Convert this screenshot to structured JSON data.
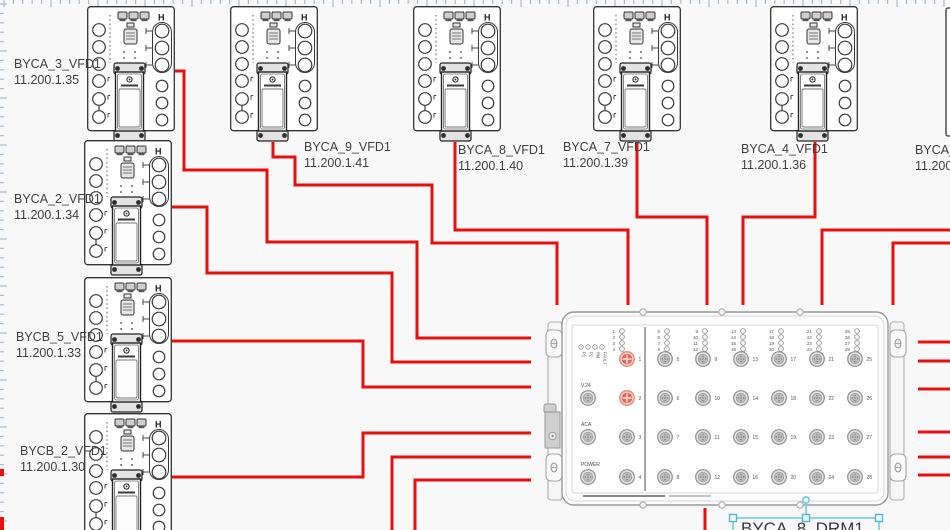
{
  "canvas": {
    "width": 950,
    "height": 530,
    "background": "#f8f8f8"
  },
  "cable_color": "#e90f0f",
  "ruler": {
    "tick_color": "#a9bdd9",
    "red_marks": [
      {
        "y": 469,
        "len": 7
      },
      {
        "y": 517,
        "len": 13
      }
    ]
  },
  "vfd_h_label": "H",
  "devices": [
    {
      "label": "BYCA_3_VFD1",
      "ip": "11.200.1.35",
      "x": 87,
      "y": 6,
      "lx": 14,
      "ly": 68,
      "sliver": false
    },
    {
      "label": "BYCA_9_VFD1",
      "ip": "11.200.1.41",
      "x": 230,
      "y": 6,
      "lx": 304,
      "ly": 151,
      "sliver": false
    },
    {
      "label": "BYCA_8_VFD1",
      "ip": "11.200.1.40",
      "x": 413,
      "y": 6,
      "lx": 458,
      "ly": 154,
      "sliver": false
    },
    {
      "label": "BYCA_7_VFD1",
      "ip": "11.200.1.39",
      "x": 593,
      "y": 6,
      "lx": 563,
      "ly": 151,
      "sliver": false
    },
    {
      "label": "BYCA_4_VFD1",
      "ip": "11.200.1.36",
      "x": 770,
      "y": 6,
      "lx": 741,
      "ly": 153,
      "sliver": false
    },
    {
      "label": "BYCA_5_",
      "ip": "11.200.1",
      "x": 946,
      "y": 8,
      "lx": 915,
      "ly": 154,
      "sliver": true
    },
    {
      "label": "BYCA_2_VFD1",
      "ip": "11.200.1.34",
      "x": 84,
      "y": 140,
      "lx": 14,
      "ly": 203,
      "sliver": false
    },
    {
      "label": "BYCB_5_VFD1",
      "ip": "11.200.1.33",
      "x": 84,
      "y": 277,
      "lx": 16,
      "ly": 341,
      "sliver": false
    },
    {
      "label": "BYCB_2_VFD1",
      "ip": "11.200.1.30",
      "x": 84,
      "y": 413,
      "lx": 20,
      "ly": 455,
      "sliver": false
    }
  ],
  "drm": {
    "label": "BYCA_8_DRM1",
    "x": 545,
    "y": 308,
    "status_leds": [
      "P1",
      "P2",
      "RM",
      "FAULT"
    ],
    "side_ports": [
      "V.24",
      "ACA",
      "POWER"
    ],
    "ports": [
      {
        "n": 1,
        "red": true
      },
      {
        "n": 2,
        "red": true
      },
      {
        "n": 3
      },
      {
        "n": 4
      },
      {
        "n": 5
      },
      {
        "n": 6
      },
      {
        "n": 7
      },
      {
        "n": 8
      },
      {
        "n": 9
      },
      {
        "n": 10
      },
      {
        "n": 11
      },
      {
        "n": 12
      },
      {
        "n": 13
      },
      {
        "n": 14
      },
      {
        "n": 15
      },
      {
        "n": 16
      },
      {
        "n": 17
      },
      {
        "n": 18
      },
      {
        "n": 19
      },
      {
        "n": 20
      },
      {
        "n": 21
      },
      {
        "n": 22
      },
      {
        "n": 23
      },
      {
        "n": 24
      },
      {
        "n": 25
      },
      {
        "n": 26
      },
      {
        "n": 27
      },
      {
        "n": 28
      }
    ]
  },
  "selection": {
    "anchor": {
      "x": 806,
      "y": 500
    },
    "box": {
      "x": 733,
      "y": 518,
      "w": 146,
      "h": 30
    },
    "handles": [
      {
        "x": 733,
        "y": 518
      },
      {
        "x": 806,
        "y": 518
      },
      {
        "x": 879,
        "y": 518
      }
    ],
    "text_x": 741,
    "text_y": 534
  },
  "cables": [
    {
      "from": "BYCA_3_VFD1",
      "to": "drm-left",
      "points": [
        [
          175,
          71
        ],
        [
          184,
          71
        ],
        [
          184,
          170
        ],
        [
          267,
          170
        ],
        [
          267,
          242
        ],
        [
          417,
          242
        ],
        [
          417,
          338
        ],
        [
          531,
          338
        ]
      ]
    },
    {
      "from": "BYCA_9_VFD1",
      "to": "drm-top",
      "points": [
        [
          273,
          142
        ],
        [
          273,
          157
        ],
        [
          295,
          157
        ],
        [
          295,
          185
        ],
        [
          432,
          185
        ],
        [
          432,
          243
        ],
        [
          557,
          243
        ],
        [
          557,
          305
        ]
      ]
    },
    {
      "from": "BYCA_8_VFD1",
      "to": "drm-top",
      "points": [
        [
          455,
          142
        ],
        [
          455,
          230
        ],
        [
          628,
          230
        ],
        [
          628,
          305
        ]
      ]
    },
    {
      "from": "BYCA_7_VFD1",
      "to": "drm-top",
      "points": [
        [
          637,
          142
        ],
        [
          637,
          217
        ],
        [
          707,
          217
        ],
        [
          707,
          305
        ]
      ]
    },
    {
      "from": "BYCA_4_VFD1",
      "to": "drm-top",
      "points": [
        [
          815,
          142
        ],
        [
          815,
          217
        ],
        [
          743,
          217
        ],
        [
          743,
          305
        ]
      ]
    },
    {
      "from": "right-edge",
      "to": "drm-top",
      "points": [
        [
          950,
          230
        ],
        [
          822,
          230
        ],
        [
          822,
          305
        ]
      ]
    },
    {
      "from": "right-edge",
      "to": "drm-top",
      "points": [
        [
          950,
          243
        ],
        [
          893,
          243
        ],
        [
          893,
          305
        ]
      ]
    },
    {
      "from": "BYCA_2_VFD1",
      "to": "drm-left",
      "points": [
        [
          172,
          207
        ],
        [
          207,
          207
        ],
        [
          207,
          273
        ],
        [
          392,
          273
        ],
        [
          392,
          362
        ],
        [
          531,
          362
        ]
      ]
    },
    {
      "from": "BYCB_5_VFD1",
      "to": "drm-left",
      "points": [
        [
          172,
          341
        ],
        [
          363,
          341
        ],
        [
          363,
          387
        ],
        [
          531,
          387
        ]
      ]
    },
    {
      "from": "BYCB_2_VFD1",
      "to": "drm-left",
      "points": [
        [
          172,
          477
        ],
        [
          363,
          477
        ],
        [
          363,
          433
        ],
        [
          531,
          433
        ]
      ]
    },
    {
      "from": "bottom-edge",
      "to": "drm-left",
      "points": [
        [
          392,
          530
        ],
        [
          392,
          457
        ],
        [
          531,
          457
        ]
      ]
    },
    {
      "from": "bottom-edge",
      "to": "drm-left",
      "points": [
        [
          415,
          530
        ],
        [
          415,
          480
        ],
        [
          531,
          480
        ]
      ]
    },
    {
      "from": "right-edge",
      "to": "drm-right",
      "points": [
        [
          950,
          342
        ],
        [
          918,
          342
        ]
      ]
    },
    {
      "from": "right-edge",
      "to": "drm-right",
      "points": [
        [
          950,
          361
        ],
        [
          918,
          361
        ]
      ]
    },
    {
      "from": "right-edge",
      "to": "drm-right",
      "points": [
        [
          950,
          389
        ],
        [
          918,
          389
        ]
      ]
    },
    {
      "from": "right-edge",
      "to": "drm-right",
      "points": [
        [
          950,
          432
        ],
        [
          918,
          432
        ]
      ]
    },
    {
      "from": "right-edge",
      "to": "drm-right",
      "points": [
        [
          950,
          457
        ],
        [
          918,
          457
        ]
      ]
    },
    {
      "from": "right-edge",
      "to": "drm-right",
      "points": [
        [
          950,
          475
        ],
        [
          918,
          475
        ]
      ]
    },
    {
      "from": "drm-bottom",
      "to": "bottom-edge",
      "points": [
        [
          705,
          508
        ],
        [
          705,
          530
        ]
      ]
    }
  ]
}
